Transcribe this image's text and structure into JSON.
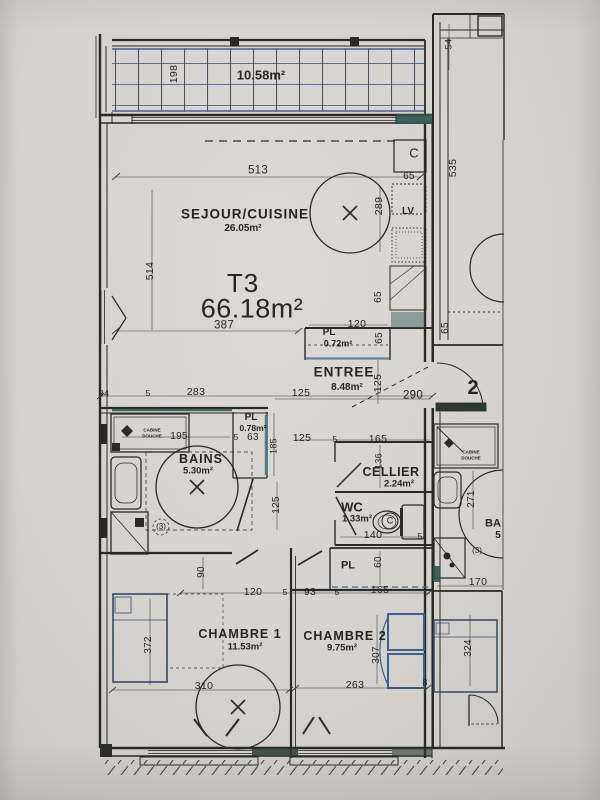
{
  "colors": {
    "paper": "#d6d3cf",
    "ink": "#2a2925",
    "tile_blue": "#5e6d99",
    "teal_marker": "#2e5450",
    "pen_blue": "#3d5f8f"
  },
  "title": {
    "type": "T3",
    "total_area": "66.18m²"
  },
  "rooms": {
    "balcon": {
      "area": "10.58m²"
    },
    "sejour": {
      "name": "SEJOUR/CUISINE",
      "area": "26.05m²"
    },
    "entree": {
      "name": "ENTREE",
      "area": "8.48m²"
    },
    "pl_entree": {
      "name": "PL",
      "area": "0.72m²"
    },
    "bains": {
      "name": "BAINS",
      "area": "5.30m²"
    },
    "pl_bains": {
      "name": "PL",
      "area": "0.78m²"
    },
    "cellier": {
      "name": "CELLIER",
      "area": "2.24m²"
    },
    "wc": {
      "name": "WC",
      "area": "1.33m²"
    },
    "pl_couloir": {
      "name": "PL"
    },
    "chambre1": {
      "name": "CHAMBRE 1",
      "area": "11.53m²"
    },
    "chambre2": {
      "name": "CHAMBRE 2",
      "area": "9.75m²"
    }
  },
  "labels": {
    "apartment_number": "2",
    "dishwasher": "LV",
    "cooktop_symbol": "C",
    "wc_symbol": "C",
    "shower_cabin_left": "CABINE DOUCHE",
    "shower_cabin_right": "CABINE DOUCHE",
    "note_left": "(3)",
    "note_right": "(3)",
    "neighbor_room_partial": "BA",
    "neighbor_area_partial": "5"
  },
  "dimensions": {
    "balcon_depth": "198",
    "loggia_top": "54",
    "loggia_side": "535",
    "loggia_bottom": "65",
    "sejour_top": "513",
    "sejour_left": "514",
    "sejour_right": "289",
    "sejour_bottom": "387",
    "kitchen_top": "65",
    "kitchen_side": "65",
    "pl_entree_width": "120",
    "pl_entree_side": "65",
    "entree_left": "125",
    "entree_height": "125",
    "entree_width": "290",
    "left_wall": "34",
    "small_5a": "5",
    "bains_top": "283",
    "bains_width": "195",
    "small_5b": "5",
    "pl_bains_width": "63",
    "pl_bains_height": "185",
    "cellier_left": "125",
    "small_5c": "5",
    "cellier_width": "165",
    "cellier_height": "136",
    "bains_door": "125",
    "wc_width": "140",
    "small_5d": "5",
    "pl_couloir_height": "60",
    "chambre1_door": "90",
    "chambre1_top": "120",
    "small_5e": "5",
    "chambre2_left": "93",
    "small_5f": "5",
    "chambre2_top": "165",
    "chambre1_bed": "372",
    "chambre2_side": "307",
    "chambre1_bottom": "310",
    "chambre2_bottom": "263",
    "right_wall": "8",
    "neighbor_bath": "271",
    "neighbor_wc": "170",
    "neighbor_bed": "324"
  }
}
